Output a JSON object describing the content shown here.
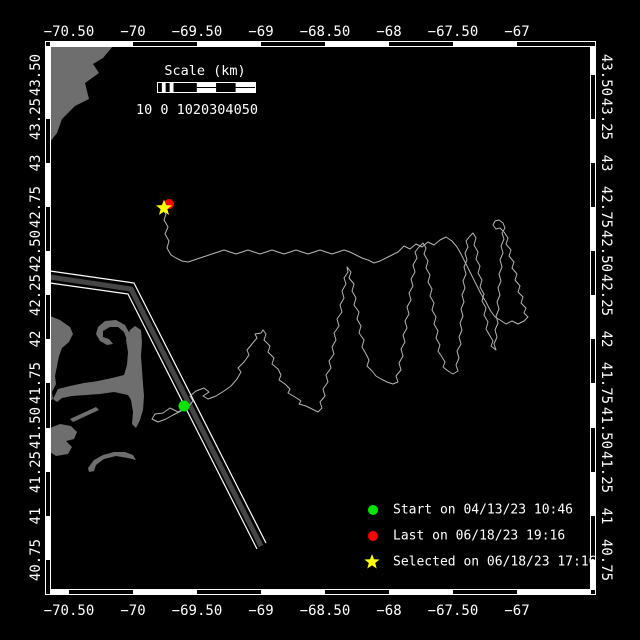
{
  "map": {
    "bg_color": "#000000",
    "frame_color": "#ffffff",
    "plot": {
      "left": 50,
      "top": 46,
      "right": 591,
      "bottom": 590
    },
    "lon_ticks": [
      {
        "label": "−70.50",
        "x": 69
      },
      {
        "label": "−70",
        "x": 133
      },
      {
        "label": "−69.50",
        "x": 197
      },
      {
        "label": "−69",
        "x": 261
      },
      {
        "label": "−68.50",
        "x": 325
      },
      {
        "label": "−68",
        "x": 389
      },
      {
        "label": "−67.50",
        "x": 453
      },
      {
        "label": "−67",
        "x": 517
      }
    ],
    "lat_ticks": [
      {
        "label": "43.50",
        "y": 75
      },
      {
        "label": "43.25",
        "y": 119
      },
      {
        "label": "43",
        "y": 163
      },
      {
        "label": "42.75",
        "y": 207
      },
      {
        "label": "42.50",
        "y": 251
      },
      {
        "label": "42.25",
        "y": 295
      },
      {
        "label": "42",
        "y": 339
      },
      {
        "label": "41.75",
        "y": 383
      },
      {
        "label": "41.50",
        "y": 428
      },
      {
        "label": "41.25",
        "y": 472
      },
      {
        "label": "41",
        "y": 516
      },
      {
        "label": "40.75",
        "y": 560
      }
    ]
  },
  "scalebar": {
    "title": "Scale (km)",
    "labels": "10 0 1020304050"
  },
  "coast": {
    "color": "#6e6e6e",
    "polygons": {
      "north-shore": "50,46 113,46 103,58 93,64 99,73 85,83 89,99 75,106 62,119 57,133 50,142",
      "boston-harbor-island": "45,225 50,225 50,229 45,229",
      "mainland-south": "50,316 60,320 70,327 73,334 69,342 62,348 59,356 57,366 55,376 56,384 52,392 53,399 50,401",
      "cape-cod-arm": "53,399 58,389 70,386 84,383 98,381 112,378 124,375 127,365 128,352 126,340 130,330 135,326 141,330 142,342 141,356 142,370 143,384 144,396 143,410 140,420 136,428 132,424 133,412 131,400 128,395 114,392 100,394 86,395 72,396 62,398 57,402",
      "cape-cod-hook": "130,334 125,325 116,320 105,321 98,327 96,334 100,341 107,345 113,344 109,339 103,337 103,331 110,327 118,327 124,332 127,340",
      "elizabeth-islands": "70,419 96,407 99,410 73,422",
      "marthas-vineyard": "50,428 60,424 71,426 77,432 74,439 66,441 72,447 68,454 56,456 50,452",
      "nantucket": "88,468 94,460 103,455 114,452 125,452 133,455 136,460 128,458 116,456 104,459 96,465 94,471 89,472"
    }
  },
  "lane": {
    "band_color": "#454545",
    "edge_color": "#ffffff",
    "band": "50,277 131,289 261,546",
    "edge1": "50,271 134,283 266,543",
    "edge2": "50,283 128,294 257,549"
  },
  "track": {
    "color": "#b5b5b5",
    "points": "186,408 178,412 170,408 163,413 155,414 152,419 158,422 166,419 173,415 181,411 188,407 193,401 190,396 196,391 204,388 209,392 203,396 208,399 216,396 224,391 231,386 237,379 241,372 238,368 244,362 249,355 247,350 252,344 257,338 255,334 261,333 263,330 266,334 264,340 270,346 268,352 274,358 272,364 278,369 281,375 279,380 285,384 290,389 288,393 295,397 301,401 299,404 306,406 312,409 318,412 322,408 320,402 325,396 323,389 328,382 326,375 331,368 329,361 334,354 332,347 336,340 334,333 339,326 337,319 342,312 340,305 344,298 342,291 346,284 344,278 348,272 347,267 351,272 349,278 354,284 352,291 356,298 354,305 359,312 357,319 361,326 359,333 364,340 362,347 366,354 369,360 367,366 372,371 376,376 381,379 387,382 393,384 398,382 396,376 401,370 399,363 403,356 401,349 405,342 403,335 407,328 405,321 409,314 407,307 411,300 409,293 413,286 411,279 415,272 413,265 417,258 415,252 419,247 423,243 426,248 424,254 428,261 426,268 430,275 428,282 432,289 430,296 434,303 432,310 436,317 434,324 438,331 436,338 440,345 438,351 442,357 445,362 443,367 448,371 453,374 458,371 456,365 459,358 457,351 461,344 459,337 462,330 460,323 463,316 461,309 464,302 462,295 465,288 463,281 466,274 464,267 467,260 465,253 468,247 466,241 470,236 473,233 476,238 474,245 478,252 476,259 480,266 478,273 482,280 480,287 484,294 482,301 486,308 484,315 488,322 486,329 490,336 493,341 491,346 496,350 494,344 497,337 495,330 498,323 496,316 499,309 497,302 500,295 498,288 501,281 499,274 502,267 500,260 503,253 501,246 504,239 502,233 505,228 503,223 499,220 495,221 493,225 496,229 500,228 504,232 508,238 506,244 511,250 509,256 514,262 512,268 517,274 515,280 520,286 518,292 523,297 521,303 526,308 524,313 528,317 524,321 518,324 512,321 506,324 500,320 495,317 490,310 486,302 481,294 477,286 473,278 469,270 465,262 461,254 457,247 452,241 446,237 440,240 434,245 428,242 422,247 416,244 410,249 404,246 398,252 392,255 386,258 380,261 374,263 368,260 362,258 356,255 350,252 344,250 338,252 332,254 326,252 320,250 314,252 308,254 302,252 296,250 290,252 284,254 278,252 272,250 266,252 260,254 254,252 248,250 242,252 236,254 230,252 224,250 218,252 212,254 206,256 200,258 194,260 188,262 182,261 176,258 171,255 167,248 169,241 165,234 168,227 164,220 166,214 163,210 164,206"
  },
  "markers": {
    "items": [
      {
        "name": "last-position-marker",
        "type": "circle",
        "color": "#ff0000",
        "x": 169,
        "y": 204,
        "r": 5
      },
      {
        "name": "selected-position-marker",
        "type": "star",
        "color": "#ffff00",
        "x": 164,
        "y": 208,
        "r": 8.5
      },
      {
        "name": "start-position-marker",
        "type": "circle",
        "color": "#00e400",
        "x": 184,
        "y": 406,
        "r": 5.5
      }
    ]
  },
  "legend": {
    "items": [
      {
        "name": "legend-start-marker",
        "type": "circle",
        "color": "#00e400",
        "x": 373,
        "y": 510,
        "r": 5,
        "label": "Start on 04/13/23 10:46"
      },
      {
        "name": "legend-last-marker",
        "type": "circle",
        "color": "#ff0000",
        "x": 373,
        "y": 536,
        "r": 5,
        "label": "Last on 06/18/23 19:16"
      },
      {
        "name": "legend-selected-marker",
        "type": "star",
        "color": "#ffff00",
        "x": 372,
        "y": 562,
        "r": 8,
        "label": "Selected on 06/18/23 17:16"
      }
    ]
  }
}
